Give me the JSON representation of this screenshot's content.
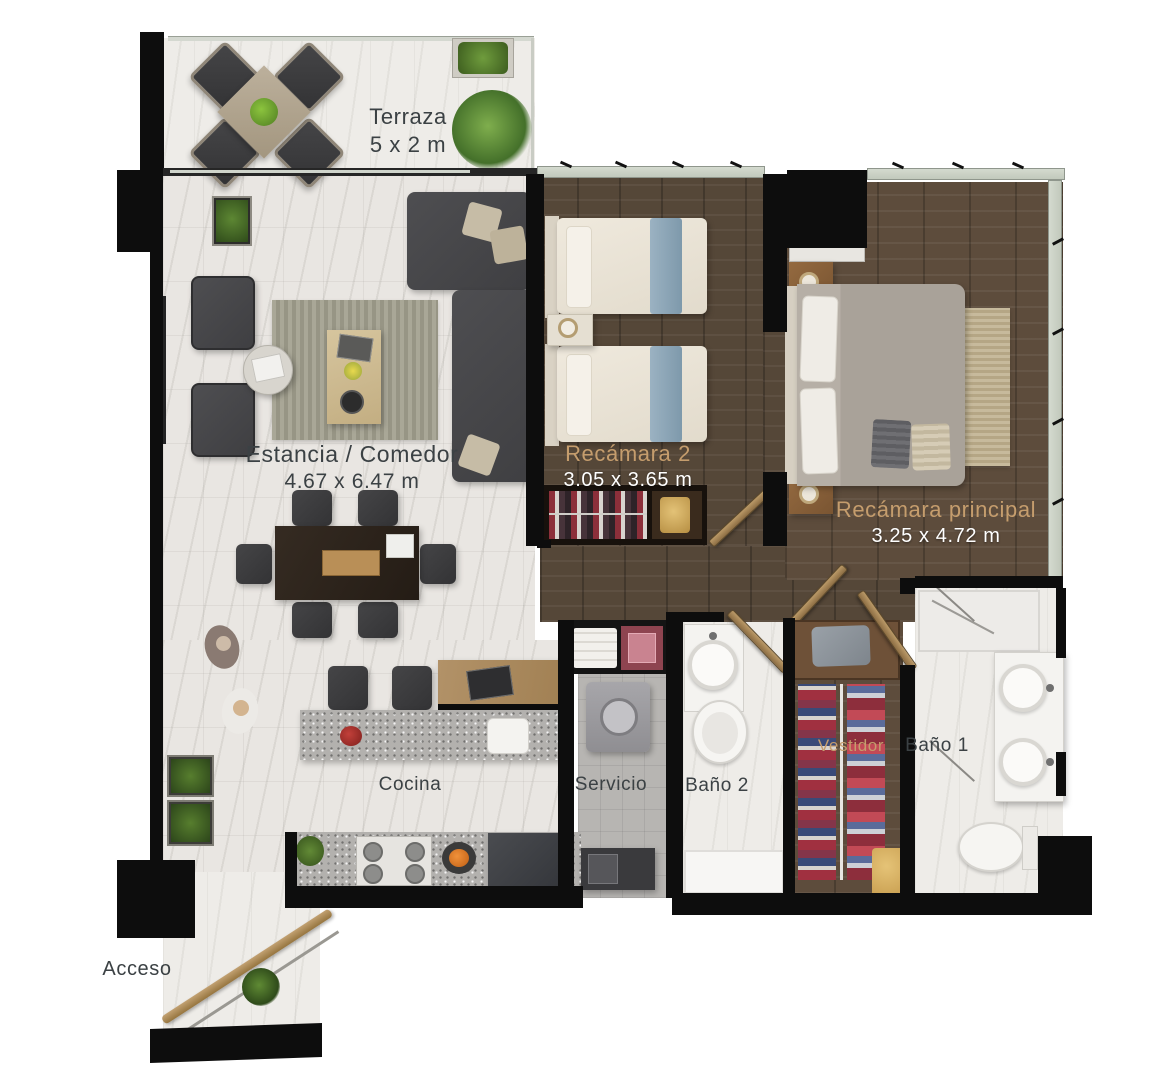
{
  "plan": {
    "type": "apartment-floor-plan",
    "unit": "m"
  },
  "rooms": {
    "terraza": {
      "label": "Terraza",
      "dims": "5 x 2 m"
    },
    "estancia": {
      "label": "Estancia / Comedor",
      "dims": "4.67 x 6.47 m"
    },
    "recamara2": {
      "label": "Recámara 2",
      "dims": "3.05 x 3.65 m"
    },
    "recamara_principal": {
      "label": "Recámara principal",
      "dims": "3.25 x 4.72 m"
    },
    "cocina": {
      "label": "Cocina"
    },
    "servicio": {
      "label": "Servicio"
    },
    "bano2": {
      "label": "Baño 2"
    },
    "vestidor": {
      "label": "Vestidor"
    },
    "bano1": {
      "label": "Baño 1"
    },
    "acceso": {
      "label": "Acceso"
    }
  },
  "colors": {
    "label_dark": "#3b4144",
    "label_gold": "#c59d6d",
    "label_white": "#ffffff",
    "wall": "#0d0d0d",
    "wood_floor": "#554738",
    "wood_floor_master": "#5d4c3c",
    "marble_floor": "#e9e6e2",
    "tile_floor": "#b7b5b2",
    "sofa_gray": "#47474a",
    "bed_cream": "#e9e3d7",
    "accent_blue": "#8ea8b9",
    "door_wood": "#a8875a"
  }
}
